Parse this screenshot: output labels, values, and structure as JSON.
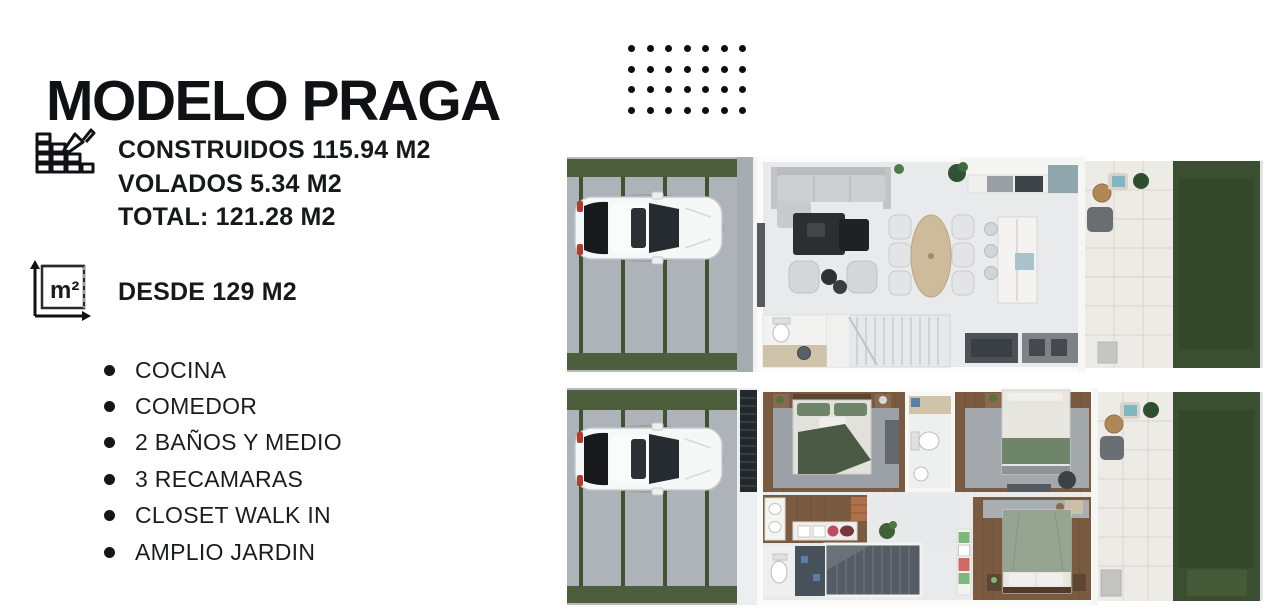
{
  "header": {
    "title": "MODELO PRAGA",
    "dot_grid": {
      "rows": 4,
      "cols": 7
    }
  },
  "specs": {
    "icon": "bricks-trowel-icon",
    "lines": [
      "CONSTRUIDOS 115.94 M2",
      "VOLADOS 5.34 M2",
      "TOTAL: 121.28 M2"
    ]
  },
  "lot": {
    "icon": "square-meters-icon",
    "icon_text": "m²",
    "label": "DESDE 129 M2"
  },
  "features": {
    "items": [
      "COCINA",
      "COMEDOR",
      "2 BAÑOS Y MEDIO",
      "3 RECAMARAS",
      "CLOSET WALK IN",
      "AMPLIO JARDIN"
    ]
  },
  "floorplans": {
    "ground": {
      "name": "planta-baja-render"
    },
    "upper": {
      "name": "planta-alta-render"
    }
  },
  "colors": {
    "ink": "#101114",
    "grass": "#4d5e3c",
    "lawn": "#3a4e31",
    "lawn_dark": "#31452a",
    "concrete": "#b6bbc1",
    "walkway": "#a7acb2",
    "wood": "#7a5b41",
    "interior": "#e9eaec",
    "patio": "#edebe6",
    "tile_line": "#d9d6d0",
    "wall": "#fbfbfa",
    "stair_dark": "#565c63",
    "stair_light": "#e7e8ea",
    "louver": "#23282d",
    "teal": "#7fb6c2",
    "bed_green": "#6f8569",
    "throw_green": "#4a5a44",
    "sage": "#96a492",
    "marble_dark": "#2c2e31",
    "table_tan": "#cdbb9b",
    "beige": "#cfc4a9",
    "rug_gray": "#9ba1a6"
  }
}
